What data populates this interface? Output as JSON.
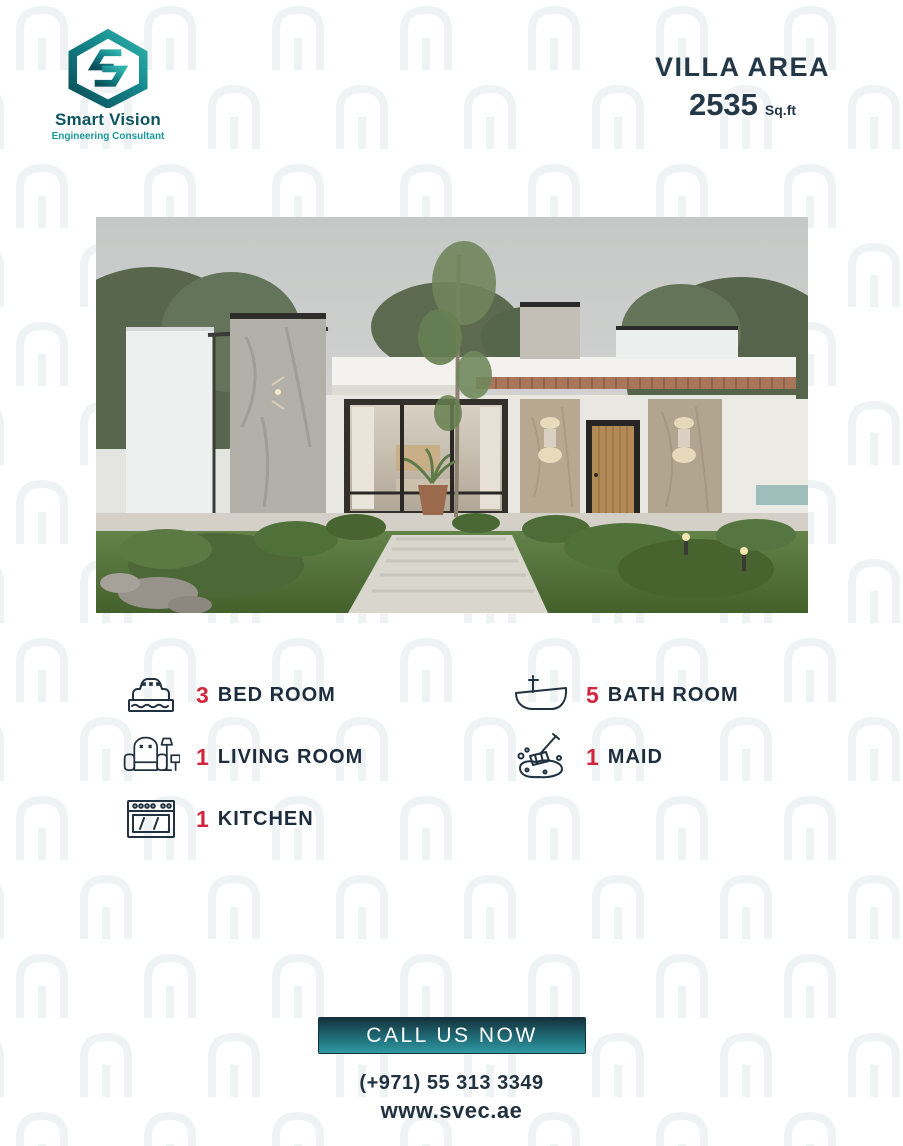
{
  "brand": {
    "name": "Smart Vision",
    "tagline": "Engineering Consultant",
    "logo_icon": "hexagon-s-logo"
  },
  "header": {
    "title": "VILLA AREA",
    "area_value": "2535",
    "area_unit": "Sq.ft"
  },
  "villa_photo": {
    "description": "Modern single-storey villa render: flat roof with wood soffit, concrete and stone pillars, glass facade, wooden door, front lawn with shrubs and tall tree",
    "icon": "villa-exterior-render"
  },
  "features": {
    "left": [
      {
        "count": "3",
        "label": "BED ROOM",
        "icon": "bed-icon"
      },
      {
        "count": "1",
        "label": "LIVING ROOM",
        "icon": "armchair-icon"
      },
      {
        "count": "1",
        "label": "KITCHEN",
        "icon": "stove-icon"
      }
    ],
    "right": [
      {
        "count": "5",
        "label": "BATH ROOM",
        "icon": "bathtub-icon"
      },
      {
        "count": "1",
        "label": "MAID",
        "icon": "mop-icon"
      }
    ]
  },
  "cta": {
    "button_label": "CALL US NOW",
    "phone": "(+971) 55 313 3349",
    "website": "www.svec.ae"
  },
  "colors": {
    "navy": "#22313f",
    "red": "#d0273e",
    "teal_dark": "#0d5a64",
    "teal": "#1b9a9c",
    "button_gradient_top": "#16323c",
    "button_gradient_bottom": "#2f9aa3"
  }
}
